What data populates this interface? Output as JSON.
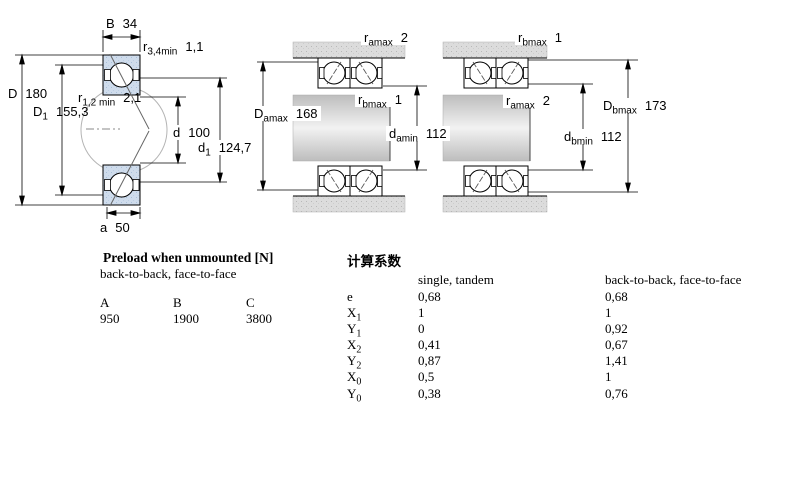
{
  "colors": {
    "bearing_section_fill": "#cfdcec",
    "bearing_section_dots": "#a9c0da",
    "metal_fill": "#dcdcdc",
    "metal_dots": "#b8b8b8",
    "shaft_gradient_edge": "#bdbdbd",
    "shaft_gradient_center": "#f2f2f2",
    "line": "#000000",
    "background": "#ffffff"
  },
  "diagram_left": {
    "B": {
      "sym": "B",
      "sub": "",
      "val": "34"
    },
    "r34": {
      "sym": "r",
      "sub": "3,4min",
      "val": "1,1"
    },
    "D": {
      "sym": "D",
      "sub": "",
      "val": "180"
    },
    "r12": {
      "sym": "r",
      "sub": "1,2 min",
      "val": "2,1"
    },
    "D1": {
      "sym": "D",
      "sub": "1",
      "val": "155,3"
    },
    "d": {
      "sym": "d",
      "sub": "",
      "val": "100"
    },
    "d1": {
      "sym": "d",
      "sub": "1",
      "val": "124,7"
    },
    "a": {
      "sym": "a",
      "sub": "",
      "val": "50"
    }
  },
  "diagram_middle": {
    "ramax": {
      "sym": "r",
      "sub": "amax",
      "val": "2"
    },
    "Damax": {
      "sym": "D",
      "sub": "amax",
      "val": "168"
    },
    "rbmax": {
      "sym": "r",
      "sub": "bmax",
      "val": "1"
    },
    "damin": {
      "sym": "d",
      "sub": "amin",
      "val": "112"
    }
  },
  "diagram_right": {
    "rbmax": {
      "sym": "r",
      "sub": "bmax",
      "val": "1"
    },
    "ramax": {
      "sym": "r",
      "sub": "amax",
      "val": "2"
    },
    "Dbmax": {
      "sym": "D",
      "sub": "bmax",
      "val": "173"
    },
    "dbmin": {
      "sym": "d",
      "sub": "bmin",
      "val": "112"
    }
  },
  "preload_table": {
    "title": "Preload when unmounted [N]",
    "subtitle": "back-to-back, face-to-face",
    "columns": [
      "A",
      "B",
      "C"
    ],
    "values": [
      "950",
      "1900",
      "3800"
    ]
  },
  "factors_table": {
    "title": "计算系数",
    "col1_header": "single, tandem",
    "col2_header": "back-to-back, face-to-face",
    "rows": [
      {
        "sym": "e",
        "sub": "",
        "v1": "0,68",
        "v2": "0,68"
      },
      {
        "sym": "X",
        "sub": "1",
        "v1": "1",
        "v2": "1"
      },
      {
        "sym": "Y",
        "sub": "1",
        "v1": "0",
        "v2": "0,92"
      },
      {
        "sym": "X",
        "sub": "2",
        "v1": "0,41",
        "v2": "0,67"
      },
      {
        "sym": "Y",
        "sub": "2",
        "v1": "0,87",
        "v2": "1,41"
      },
      {
        "sym": "X",
        "sub": "0",
        "v1": "0,5",
        "v2": "1"
      },
      {
        "sym": "Y",
        "sub": "0",
        "v1": "0,38",
        "v2": "0,76"
      }
    ]
  }
}
